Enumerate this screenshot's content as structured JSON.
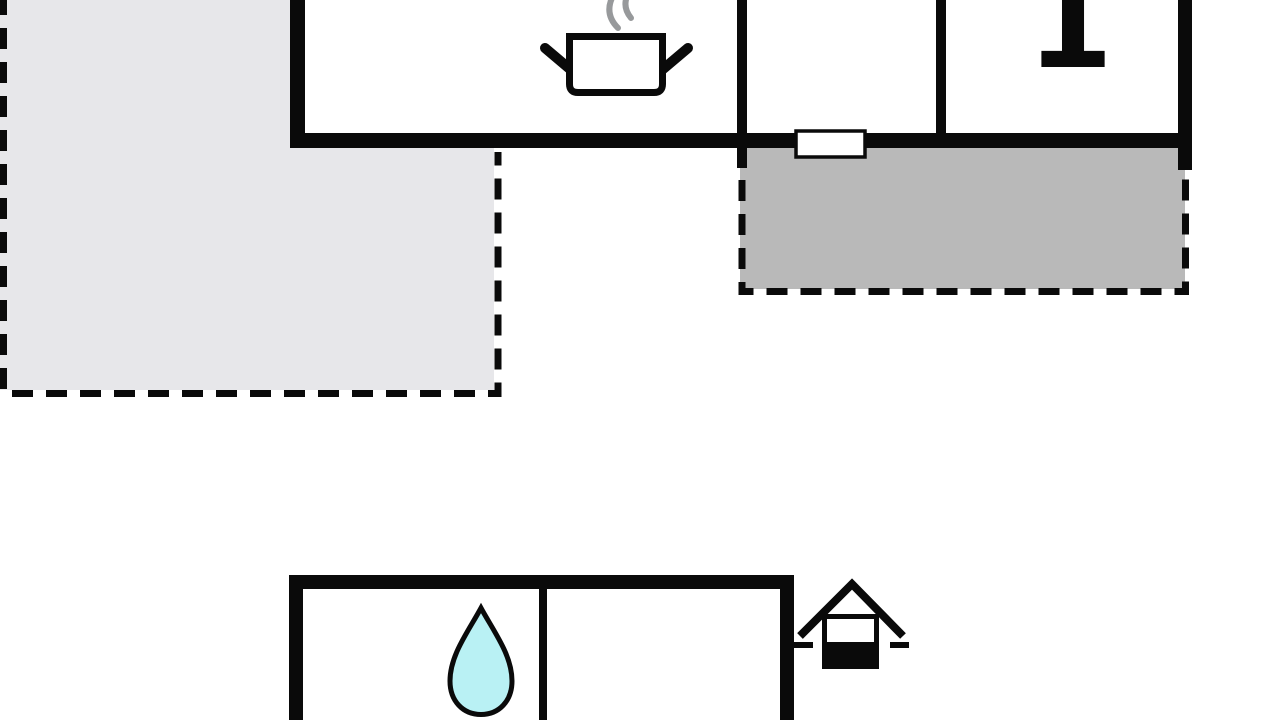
{
  "canvas": {
    "background": "#ffffff"
  },
  "colors": {
    "wall": "#0a0a0a",
    "terrace_light_fill": "#e7e7ea",
    "terrace_dark_fill": "#b9b9b9",
    "steam_stroke": "#97999b",
    "drop_fill": "#b9f1f4",
    "interior_fill": "#ffffff",
    "window_fill": "#ffffff"
  },
  "labels": {
    "room_number": "1"
  },
  "icons": {
    "cooking_pot_icon": "pot-with-steam",
    "water_drop_icon": "teardrop",
    "entrance_icon": "house-half-filled",
    "window_marker": "white-rect-on-wall"
  },
  "areas": {
    "terrace_left": "terrace-left-dashed",
    "terrace_right": "terrace-right-dashed",
    "main_building": "main-building",
    "outbuilding": "outbuilding"
  }
}
